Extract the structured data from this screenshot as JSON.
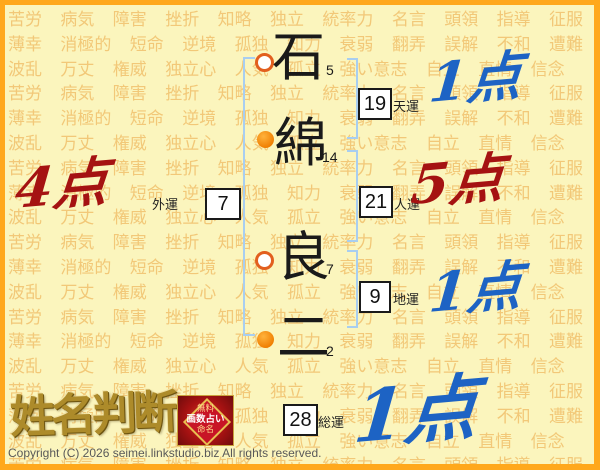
{
  "background": {
    "words": [
      "苦労",
      "病気",
      "障害",
      "挫折",
      "知略",
      "独立",
      "統率力",
      "名言",
      "頭領",
      "指導",
      "征服",
      "薄幸",
      "消極的",
      "短命",
      "逆境",
      "孤独",
      "知力",
      "衰弱",
      "翻弄",
      "誤解",
      "不和",
      "遭難",
      "波乱",
      "万丈",
      "権威",
      "独立心",
      "人気",
      "孤立",
      "強い意志",
      "自立",
      "直情",
      "信念"
    ]
  },
  "name": {
    "characters": [
      {
        "char": "石",
        "strokes": "5",
        "marker": "open"
      },
      {
        "char": "綿",
        "strokes": "14",
        "marker": "filled"
      },
      {
        "char": "良",
        "strokes": "7",
        "marker": "open"
      },
      {
        "char": "二",
        "strokes": "2",
        "marker": "filled"
      }
    ]
  },
  "fortune": {
    "ten": {
      "value": "19",
      "label": "天運",
      "score": "1点",
      "score_color": "#1D63C4"
    },
    "jin": {
      "value": "21",
      "label": "人運",
      "score": "5点",
      "score_color": "#A51212"
    },
    "chi": {
      "value": "9",
      "label": "地運",
      "score": "1点",
      "score_color": "#1D63C4"
    },
    "gai": {
      "value": "7",
      "label": "外運",
      "score": "4点",
      "score_color": "#A51212"
    },
    "sou": {
      "value": "28",
      "label": "総運",
      "score": "1点",
      "score_color": "#1D63C4"
    }
  },
  "logo": {
    "title": "姓名判断",
    "badge": {
      "line1": "無料",
      "line2": "画数占い",
      "line3": "命名"
    }
  },
  "footer": {
    "copyright": "Copyright (C) 2026 seimei.linkstudio.biz All rights reserved."
  },
  "colors": {
    "frame": "#FFA81C",
    "background": "#FBF5BD",
    "watermark_text": "#F2C878",
    "bracket": "#A8CEF0",
    "score_blue": "#1D63C4",
    "score_red": "#A51212"
  }
}
